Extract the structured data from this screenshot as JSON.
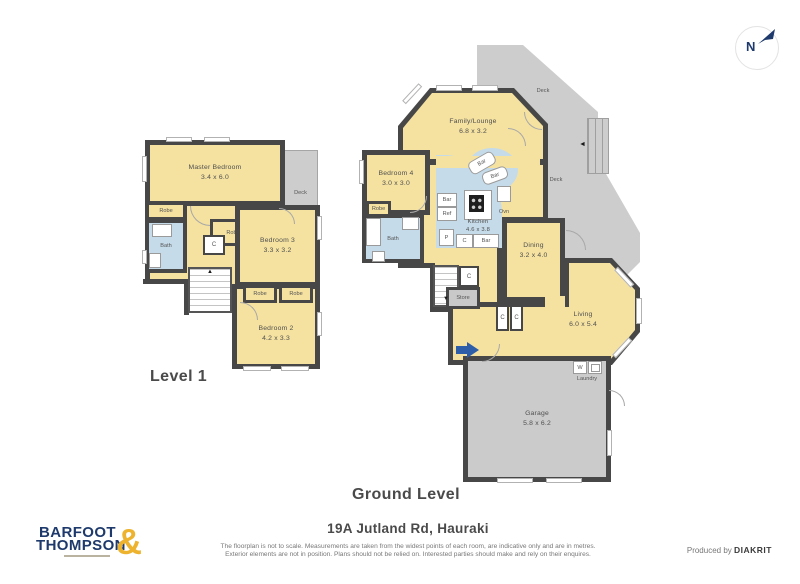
{
  "colors": {
    "room_yellow": "#F5E2A0",
    "wet_area_blue": "#C5DBE9",
    "deck_gray": "#CDCDCD",
    "wall_dark": "#474747",
    "logo_navy": "#1E3A6C",
    "logo_gold": "#EDB32F",
    "entry_arrow_blue": "#2F5EA8"
  },
  "compass": {
    "label": "N"
  },
  "level1": {
    "title": "Level 1",
    "master": {
      "name": "Master Bedroom",
      "dims": "3.4 x 6.0"
    },
    "deck": "Deck",
    "robe_left": "Robe",
    "bath": "Bath",
    "cupboard": "C",
    "robe_mid": "Robe",
    "bedroom3": {
      "name": "Bedroom 3",
      "dims": "3.3 x 3.2"
    },
    "robe_small_1": "Robe",
    "robe_small_2": "Robe",
    "bedroom2": {
      "name": "Bedroom 2",
      "dims": "4.2 x 3.3"
    }
  },
  "ground": {
    "title": "Ground Level",
    "family_lounge": {
      "name": "Family/Lounge",
      "dims": "6.8 x 3.2"
    },
    "deck_top": "Deck",
    "deck_right": "Deck",
    "bedroom4": {
      "name": "Bedroom 4",
      "dims": "3.0 x 3.0"
    },
    "robe": "Robe",
    "bath": "Bath",
    "kitchen": {
      "name": "Kitchen",
      "dims": "4.6 x 3.8"
    },
    "bar_curve_1": "Bar",
    "bar_curve_2": "Bar",
    "bar_left": "Bar",
    "ref": "Ref",
    "pantry": "P",
    "cupboard_kitchen": "C",
    "bar_bottom": "Bar",
    "oven": "Ovn",
    "dining": {
      "name": "Dining",
      "dims": "3.2 x 4.0"
    },
    "cupboard_stairs": "C",
    "store": "Store",
    "cupboard_hall_1": "C",
    "cupboard_hall_2": "C",
    "living": {
      "name": "Living",
      "dims": "6.0 x 5.4"
    },
    "washer": "W",
    "laundry": "Laundry",
    "garage": {
      "name": "Garage",
      "dims": "5.8 x 6.2"
    }
  },
  "footer": {
    "address": "19A Jutland Rd, Hauraki",
    "disclaimer_line1": "The floorplan is not to scale. Measurements are taken from the widest points of each room, are indicative only and are in metres.",
    "disclaimer_line2": "Exterior elements are not in position. Plans should not be relied on. Interested parties should make and rely on their enquires.",
    "produced_prefix": "Produced by",
    "produced_brand": "DIAKRIT"
  },
  "logo": {
    "word1": "BARFOOT",
    "word2": "THOMPSON",
    "amp": "&"
  }
}
